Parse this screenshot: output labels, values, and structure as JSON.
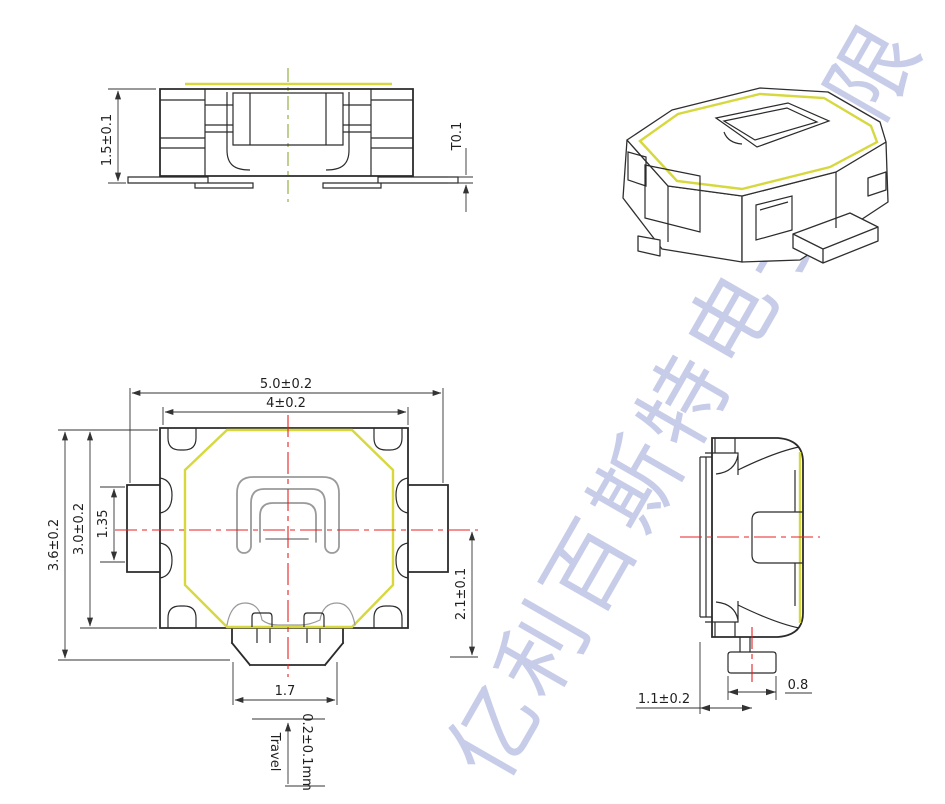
{
  "watermark": {
    "text": "亿利百斯特电子有限",
    "color": "#9aa3d6"
  },
  "colors": {
    "outline": "#2b2b2b",
    "cover_highlight_yellow": "#d6d83e",
    "centerline_red": "#e82020",
    "centerline_green": "#8aa832",
    "detail_gray": "#9a9a9a",
    "background": "#ffffff"
  },
  "views": {
    "front": {
      "height": "1.5±0.1",
      "terminal_thickness": "T0.1"
    },
    "top": {
      "overall_width": "5.0±0.2",
      "body_width": "4±0.2",
      "overall_depth": "3.6±0.2",
      "body_depth": "3.0±0.2",
      "terminal_width": "1.35",
      "stem_to_center": "2.1±0.1",
      "stem_width": "1.7",
      "travel_label": "Travel",
      "travel_value": "0.2±0.1mm"
    },
    "side": {
      "stem_offset": "1.1±0.2",
      "stem_foot_width": "0.8"
    }
  }
}
